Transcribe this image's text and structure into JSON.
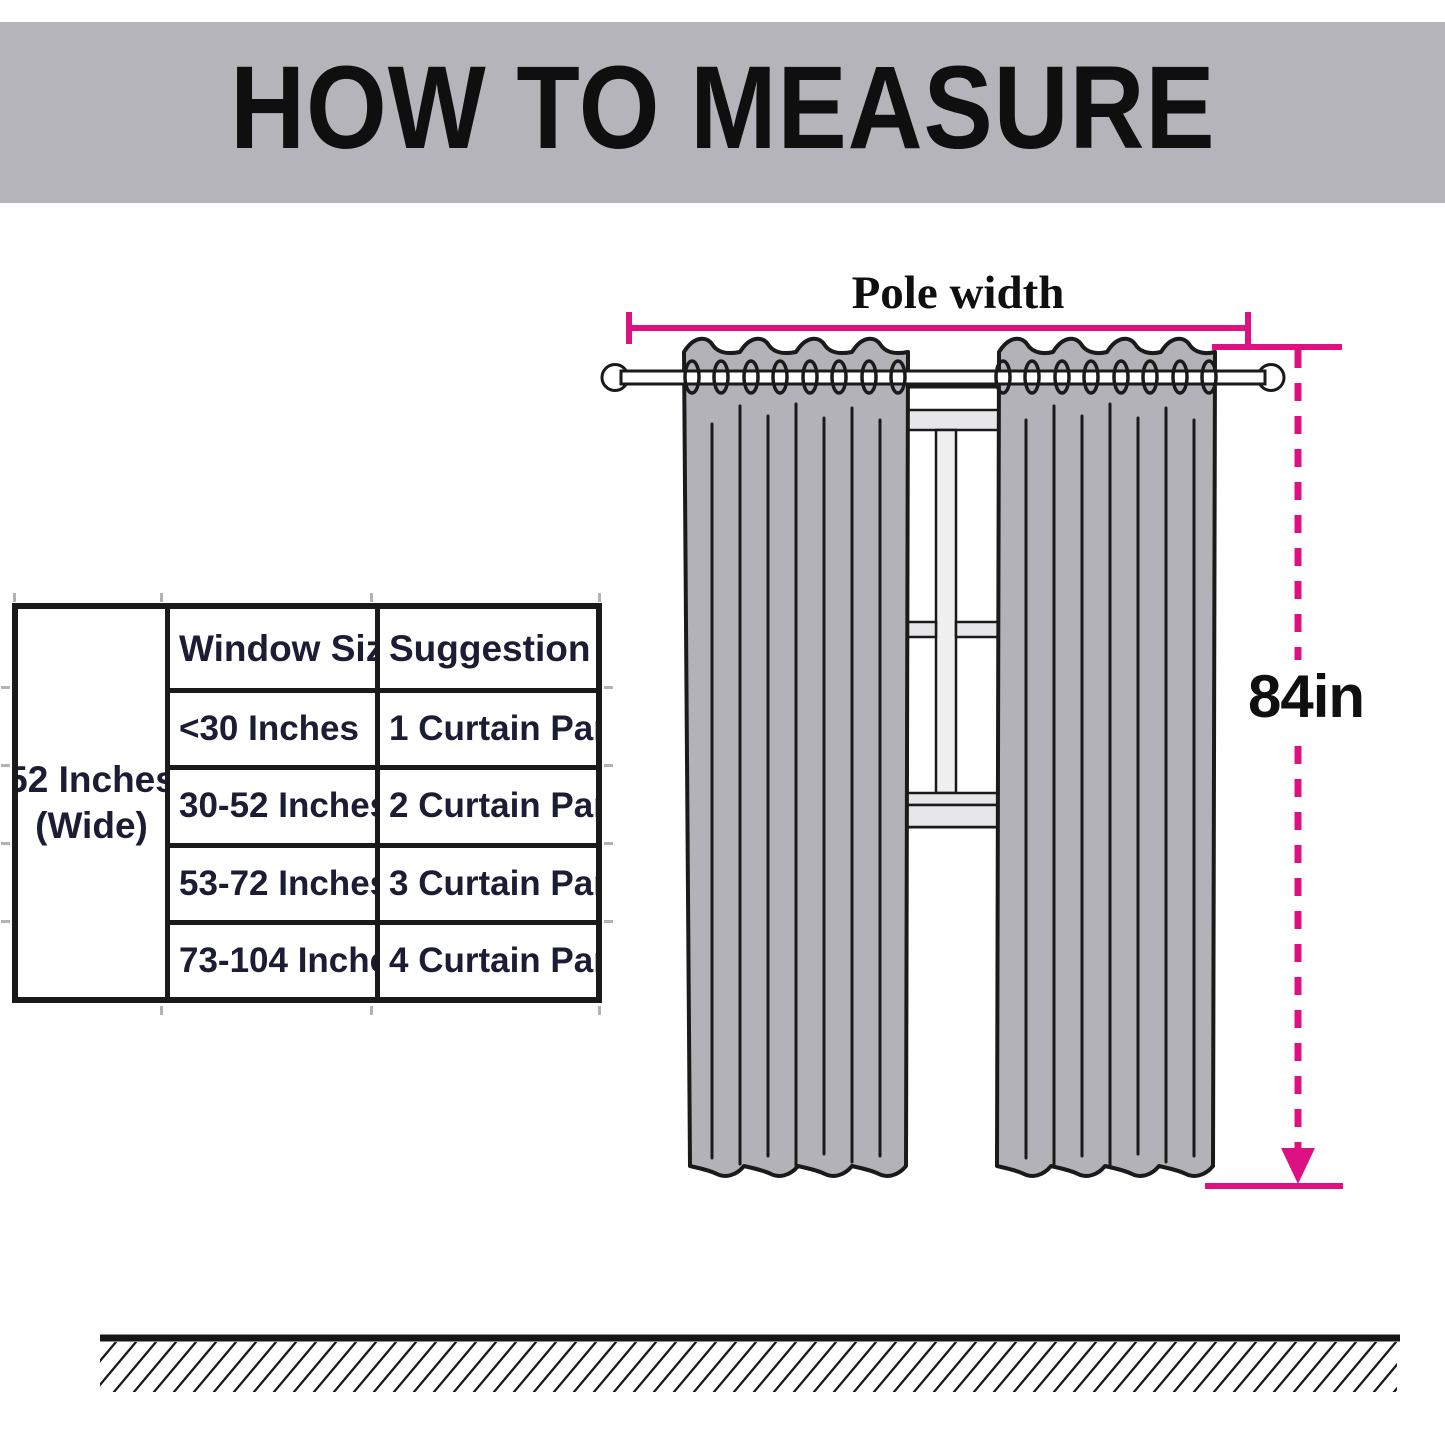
{
  "banner": {
    "title": "HOW TO MEASURE"
  },
  "table": {
    "side_label_line1": "52 Inches",
    "side_label_line2": "(Wide)",
    "headers": [
      "Window Size",
      "Suggestion"
    ],
    "rows": [
      [
        "<30 Inches",
        "1 Curtain Panel"
      ],
      [
        "30-52 Inches",
        "2 Curtain Panel"
      ],
      [
        "53-72 Inches",
        "3 Curtain Panel"
      ],
      [
        "73-104 Inches",
        "4 Curtain Panel"
      ]
    ]
  },
  "labels": {
    "pole_width": "Pole width",
    "height": "84in"
  },
  "colors": {
    "page-bg": "#ffffff",
    "banner-bg": "#b5b4ba",
    "ink": "#0f0f0f",
    "line": "#1a1a1a",
    "table-ink": "#1c1c35",
    "curtain": "#b3b2b9",
    "frame-light": "#e7e7e9",
    "mullion": "#f0f0f1",
    "accent": "#de1182"
  }
}
